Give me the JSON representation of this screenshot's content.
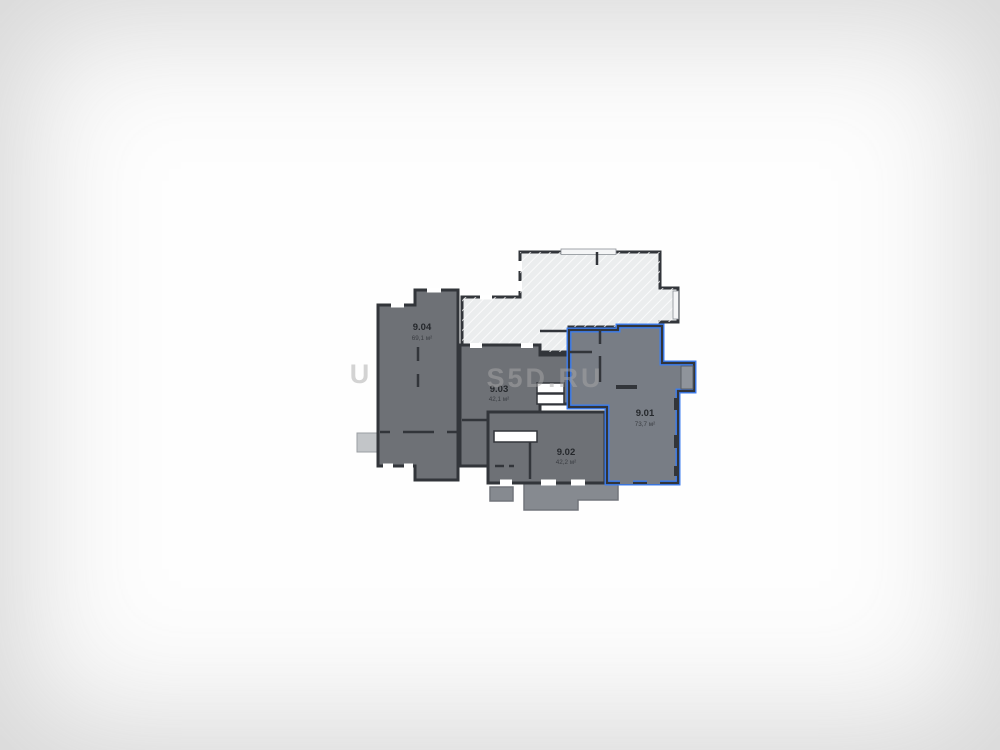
{
  "watermark": {
    "text": "S5D.RU",
    "partial_left": "U"
  },
  "units": [
    {
      "id": "9.01",
      "area": "73,7 м²",
      "highlighted": true
    },
    {
      "id": "9.02",
      "area": "42,2 м²",
      "highlighted": false
    },
    {
      "id": "9.03",
      "area": "42,1 м²",
      "highlighted": false
    },
    {
      "id": "9.04",
      "area": "69,1 м²",
      "highlighted": false
    }
  ],
  "colors": {
    "highlight": "#3d7ef0",
    "unit_fill": "#6e7176",
    "highlight_fill": "#787d85",
    "light_fill": "#ebedee",
    "wall": "#32353a",
    "label": "#25282c"
  }
}
